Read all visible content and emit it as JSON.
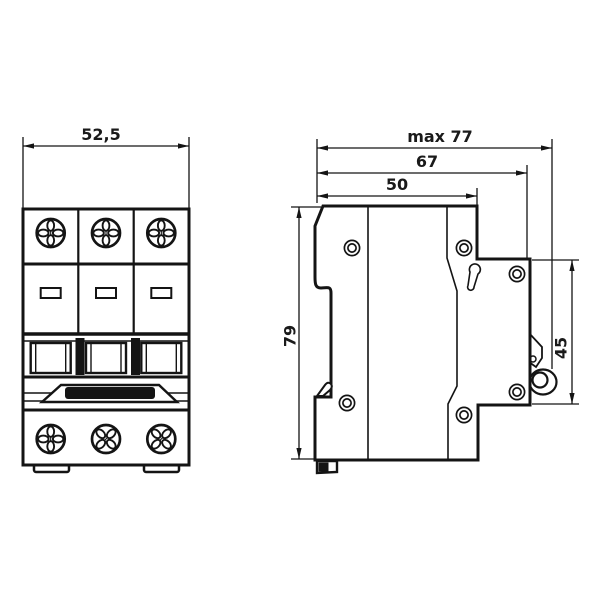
{
  "drawing": {
    "type": "technical-dimension-drawing",
    "subject": "3-pole modular circuit breaker, front view and side view",
    "line_color": "#141414",
    "text_color": "#1a1a1a",
    "background_color": "#ffffff",
    "dimensions": [
      {
        "id": "front-width",
        "label": "52,5",
        "view": "front",
        "orientation": "horizontal"
      },
      {
        "id": "side-max-depth",
        "label": "max 77",
        "view": "side",
        "orientation": "horizontal"
      },
      {
        "id": "side-depth-67",
        "label": "67",
        "view": "side",
        "orientation": "horizontal"
      },
      {
        "id": "side-depth-50",
        "label": "50",
        "view": "side",
        "orientation": "horizontal"
      },
      {
        "id": "side-height-79",
        "label": "79",
        "view": "side",
        "orientation": "vertical"
      },
      {
        "id": "side-height-45",
        "label": "45",
        "view": "side",
        "orientation": "vertical"
      }
    ],
    "front_view": {
      "modules": 3,
      "features": [
        "phillips-screw-icon",
        "label-window",
        "toggle-slot",
        "handle-tie-bar",
        "mounting-feet"
      ]
    },
    "side_view": {
      "features": [
        "rivet-icon",
        "din-rail-clip",
        "release-tab",
        "terminal-clamp-loop",
        "keyhole-slot"
      ]
    }
  }
}
